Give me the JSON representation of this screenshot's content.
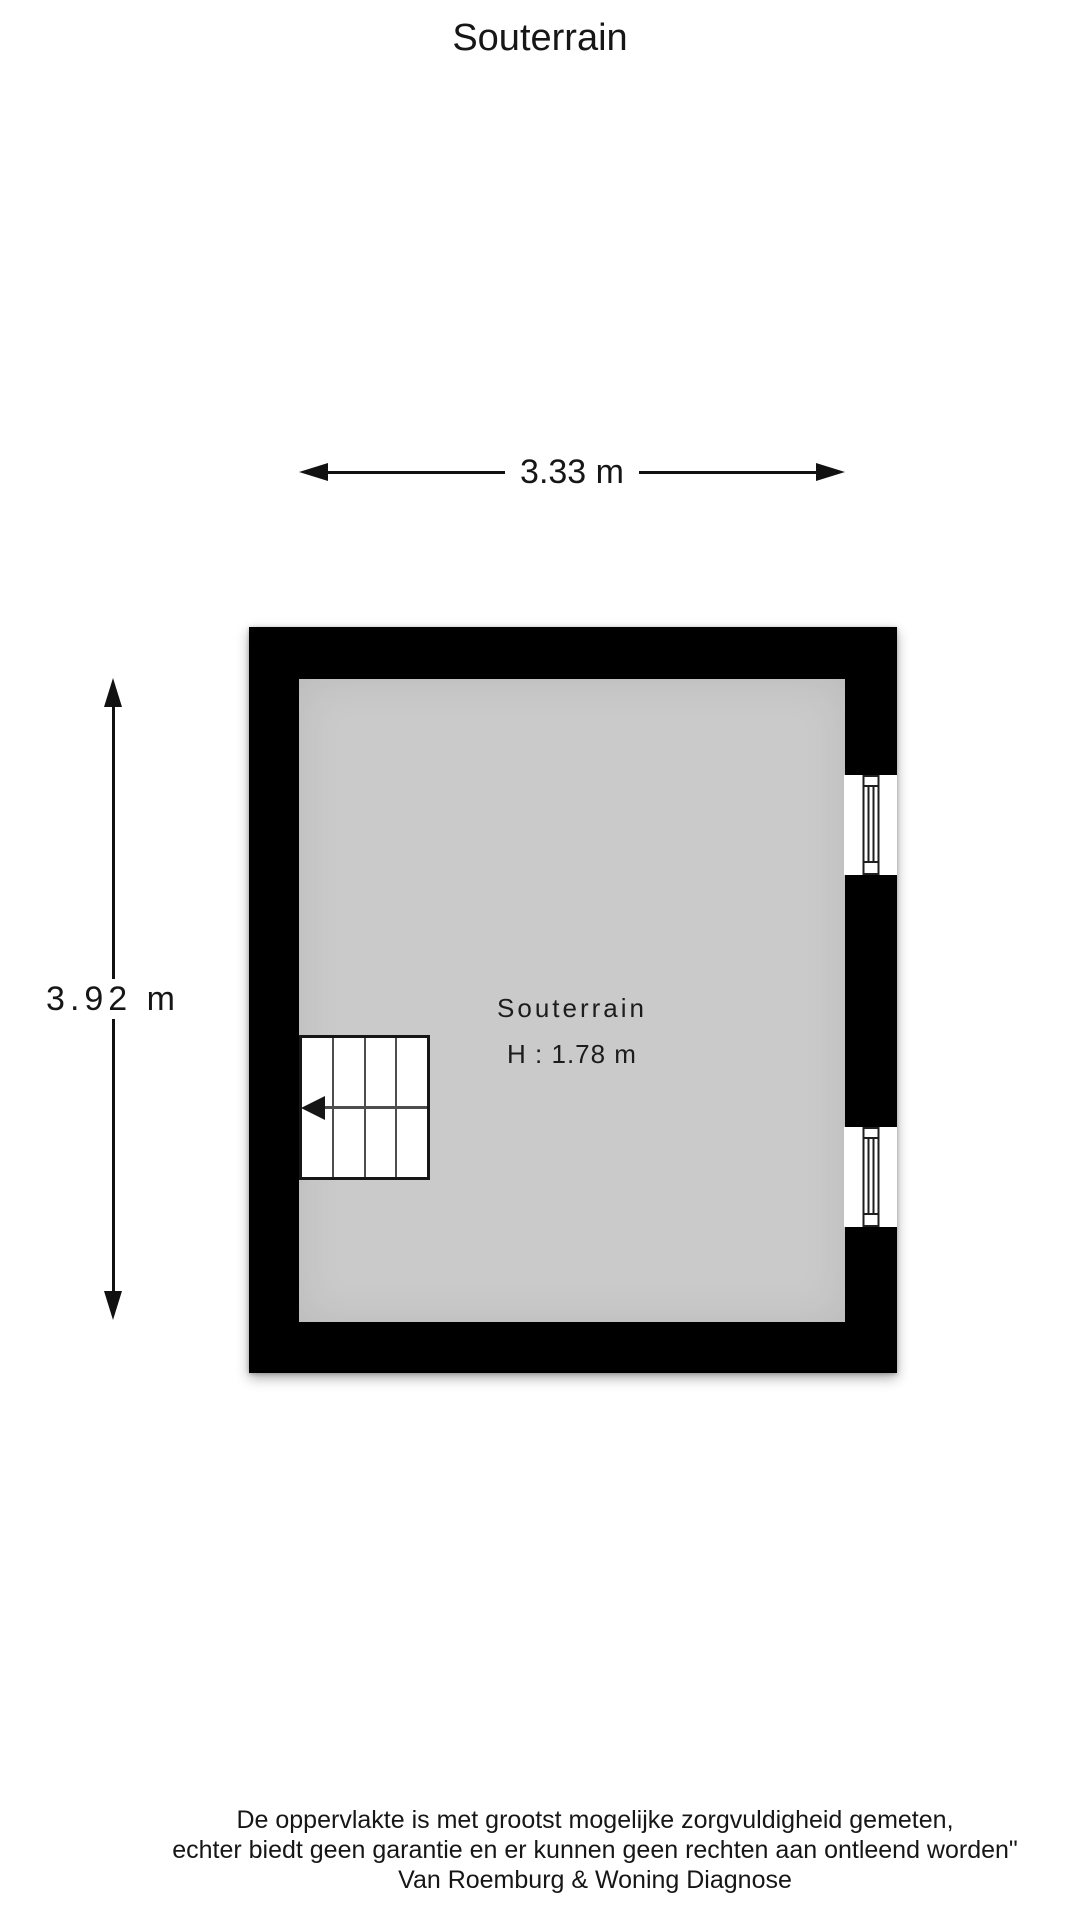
{
  "page": {
    "title": "Souterrain"
  },
  "dimensions": {
    "width_label": "3.33 m",
    "height_label": "3.92 m"
  },
  "room": {
    "name": "Souterrain",
    "ceiling_height_label": "H : 1.78 m"
  },
  "footer": {
    "line1": "De oppervlakte is met grootst mogelijke zorgvuldigheid gemeten,",
    "line2": "echter biedt geen garantie en er kunnen geen rechten aan ontleend worden\"",
    "line3": "Van Roemburg & Woning Diagnose"
  },
  "colors": {
    "wall": "#000000",
    "floor": "#cacaca",
    "window_frame": "#1f1f1f",
    "stair_lines": "#4d4d4d",
    "text": "#161616",
    "background": "#ffffff"
  }
}
